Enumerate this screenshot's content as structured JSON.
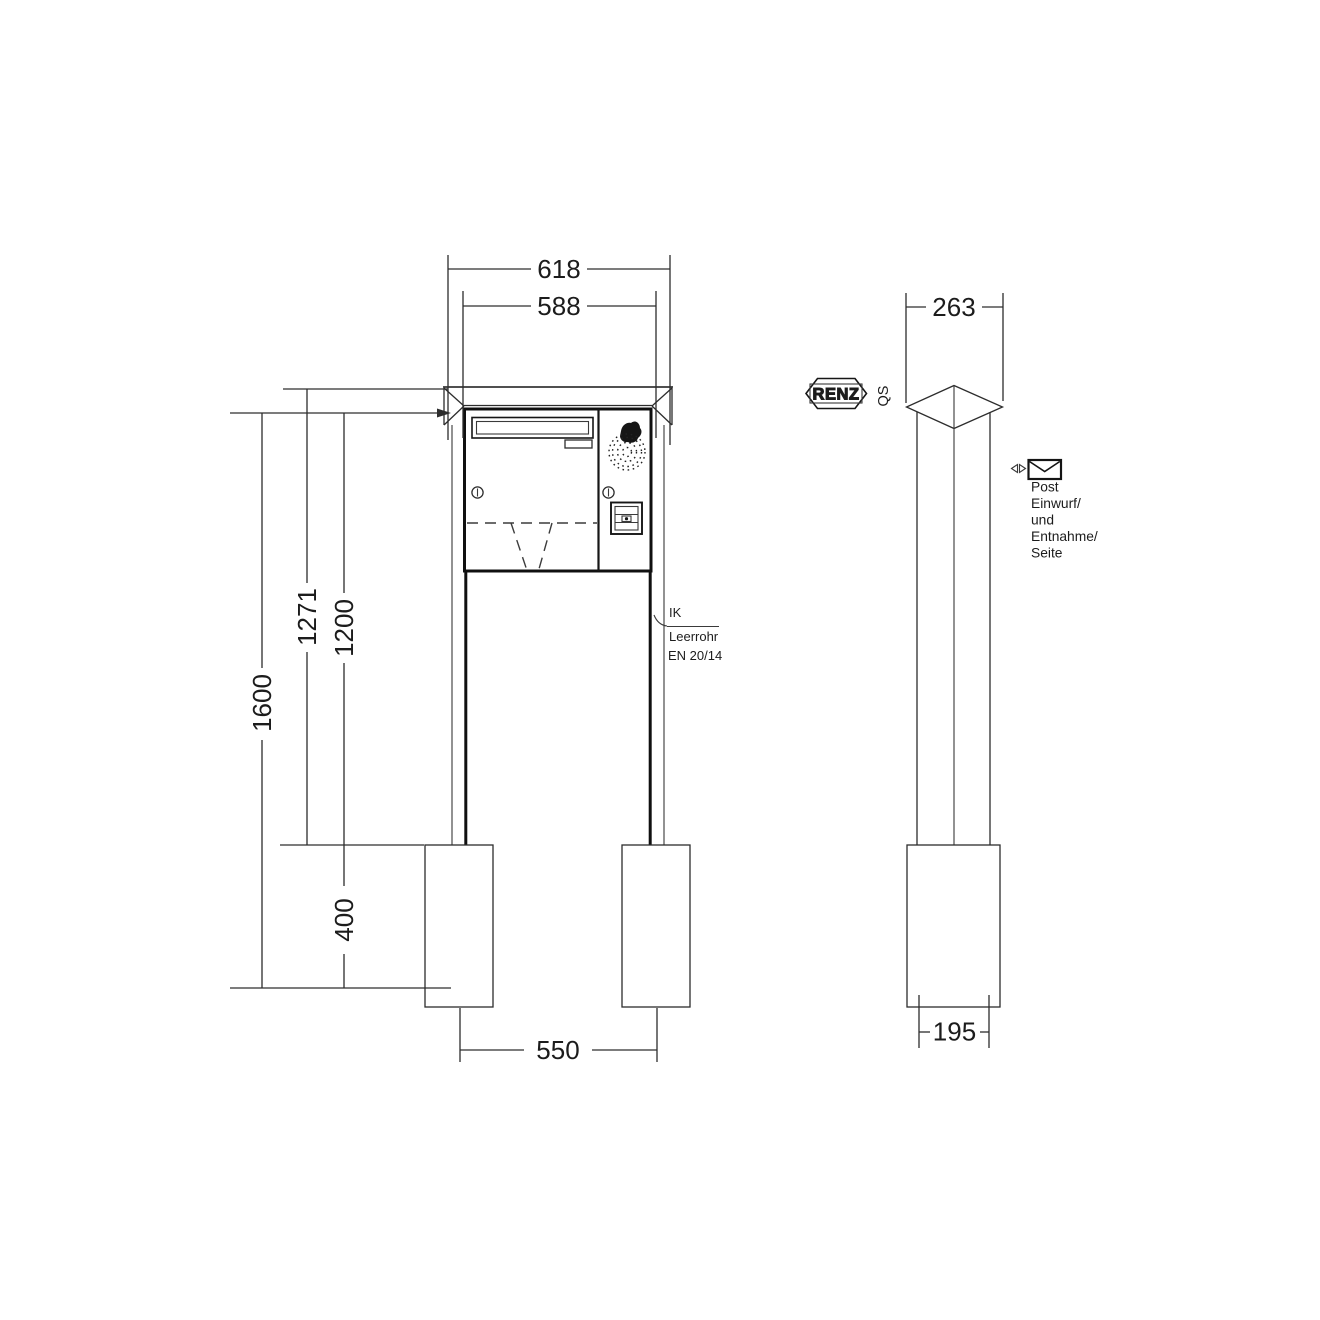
{
  "page": {
    "background": "#ffffff",
    "line_color": "#2d2d2d"
  },
  "views": {
    "front": {
      "dimensions": {
        "cap_width_mm": "618",
        "body_width_mm": "588",
        "height_with_cap_mm": "1271",
        "height_body_top_mm": "1200",
        "total_height_mm": "1600",
        "foundation_depth_mm": "400",
        "post_spacing_mm": "550"
      },
      "annotations": {
        "conduit_line1": "IK",
        "conduit_line2": "Leerrohr",
        "conduit_line3": "EN 20/14"
      }
    },
    "side": {
      "dimensions": {
        "depth_mm": "263",
        "foundation_width_mm": "195"
      },
      "brand": "RENZ",
      "qs_mark": "QS",
      "note_lines": [
        "Post",
        "Einwurf/",
        "und",
        "Entnahme/",
        "Seite"
      ]
    }
  },
  "icons": {
    "envelope": "envelope-icon",
    "view_direction": "direction-arrows-icon",
    "speaker": "speaker-grille-icon",
    "microphone": "microphone-icon",
    "lock": "lock-cylinder-icon",
    "bell_button": "bell-button-icon"
  }
}
